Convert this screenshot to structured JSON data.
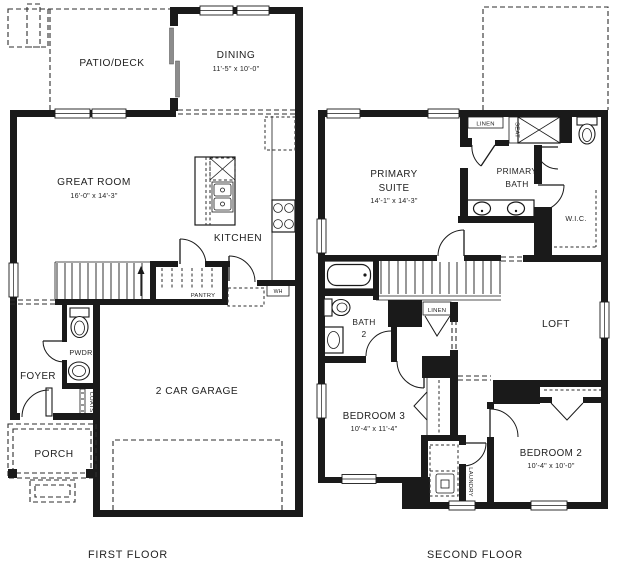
{
  "first_floor": {
    "title": "FIRST FLOOR",
    "patio": "PATIO/DECK",
    "dining": "DINING",
    "dining_dims": "11'-5\" x 10'-0\"",
    "great_room": "GREAT ROOM",
    "great_room_dims": "16'-0\" x 14'-3\"",
    "kitchen": "KITCHEN",
    "pantry": "PANTRY",
    "water_heater": "WH",
    "powder": "PWDR",
    "foyer": "FOYER",
    "coats": "COATS",
    "garage": "2 CAR GARAGE",
    "porch": "PORCH"
  },
  "second_floor": {
    "title": "SECOND FLOOR",
    "primary_suite_line1": "PRIMARY",
    "primary_suite_line2": "SUITE",
    "primary_suite_dims": "14'-1\" x 14'-3\"",
    "linen_bath": "LINEN",
    "seat": "SEAT",
    "primary_bath_line1": "PRIMARY",
    "primary_bath_line2": "BATH",
    "wic": "W.I.C.",
    "bath2_line1": "BATH",
    "bath2_line2": "2",
    "linen_hall": "LINEN",
    "loft": "LOFT",
    "bedroom3": "BEDROOM 3",
    "bedroom3_dims": "10'-4\" x 11'-4\"",
    "laundry": "LAUNDRY",
    "bedroom2": "BEDROOM 2",
    "bedroom2_dims": "10'-4\" x 10'-0\""
  }
}
